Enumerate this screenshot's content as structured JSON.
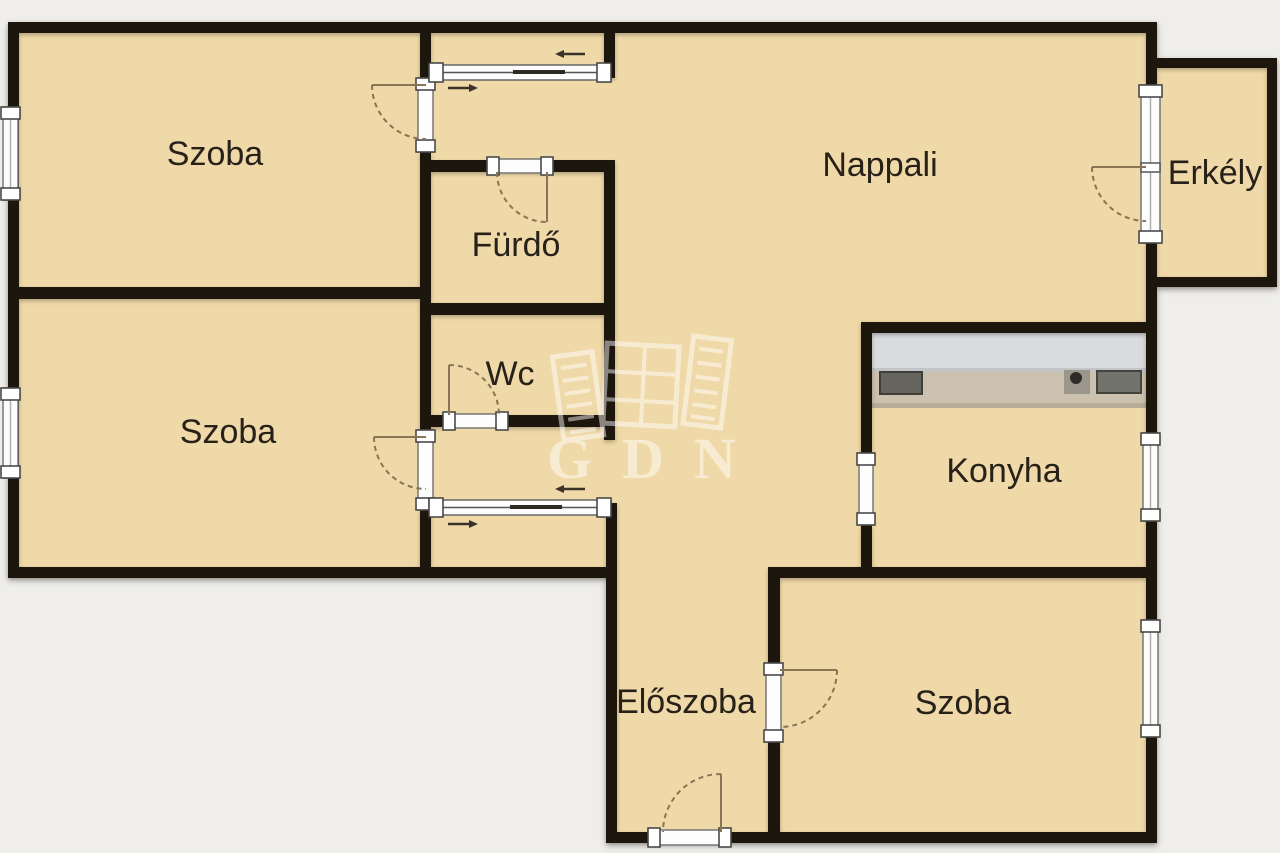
{
  "watermark": {
    "brand": "GDN"
  },
  "rooms": {
    "szoba_top_left": "Szoba",
    "szoba_mid_left": "Szoba",
    "furdo": "Fürdő",
    "wc": "Wc",
    "nappali": "Nappali",
    "erkely": "Erkély",
    "konyha": "Konyha",
    "eloszoba": "Előszoba",
    "szoba_bottom": "Szoba"
  },
  "colors": {
    "background": "#efeeeb",
    "room_fill": "#f0d9a8",
    "wall": "#1a1710",
    "door_arc": "#8a7454",
    "fixture_white": "#fdfdfd",
    "watermark": "#ffffff"
  }
}
